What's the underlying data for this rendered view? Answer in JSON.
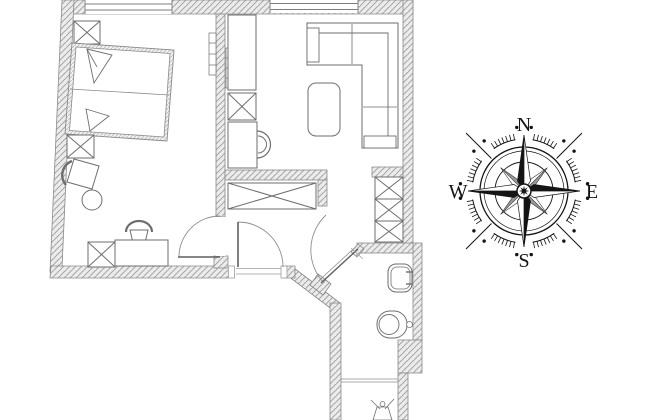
{
  "title": "apartment floor plan with compass rose",
  "compass": {
    "north": "N",
    "east": "E",
    "south": "S",
    "west": "W"
  },
  "colors": {
    "background": "#ffffff",
    "wall_fill": "#ececec",
    "wall_hatch": "#a9a9a9",
    "wall_outline": "#8a8a8a",
    "plan_line": "#6e6e6e",
    "compass_ink": "#141414"
  }
}
